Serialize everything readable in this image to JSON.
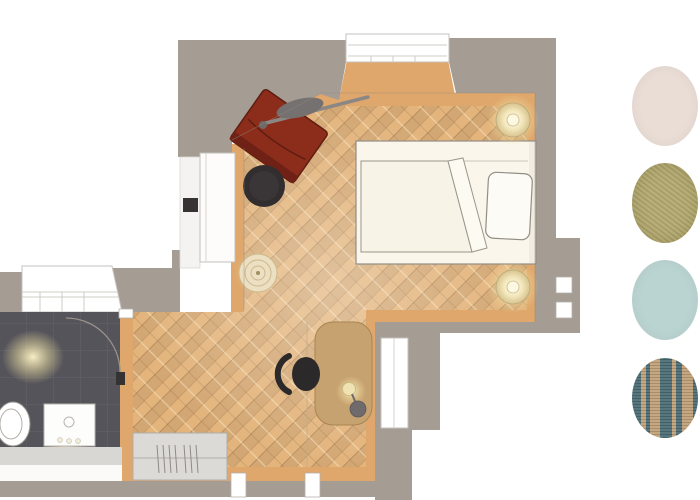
{
  "scene": {
    "kind": "apartment-floor-plan-render",
    "colors": {
      "wall": "#a59c94",
      "wall_face": "#dfa76c",
      "floor": "#e3b47c",
      "tile": "#55545a",
      "tile_grid": "#65646b",
      "window_frame": "#c6c2bd",
      "fixture": "#ffffff",
      "radiator": "#dcdad7",
      "radiator_line": "#b0ada8",
      "bed": "#faf6ec",
      "bed_outline": "#918e86",
      "duvet": "#f8f3e7",
      "pillow": "#fdfbf5",
      "chair_red": "#8c2d1c",
      "chair_red_dark": "#5f1d10",
      "pouf": "#322e2f",
      "basket": "#ecdfc2",
      "basket_ring": "#cbb98e",
      "desk": "#c7a271",
      "desk_edge": "#a8854f",
      "office_chair": "#2c292a",
      "lamp_shade": "#6f6b6d",
      "wardrobe": "#fdfcfa",
      "handle": "#363233"
    },
    "rooms": [
      "bedroom",
      "hallway",
      "bathroom"
    ],
    "furniture": [
      "bed",
      "pillow",
      "duvet",
      "bedside-lamp",
      "bedside-lamp",
      "red-armchair",
      "floor-lamp",
      "pouf",
      "round-basket",
      "wardrobe",
      "desk",
      "desk-lamp",
      "office-chair",
      "toilet",
      "vanity-sink",
      "radiator",
      "ceiling-light"
    ]
  },
  "palette": {
    "swatches": [
      {
        "name": "blush-plaster",
        "style": "solid",
        "color": "#eaddd6"
      },
      {
        "name": "olive-gold-linen",
        "style": "textured",
        "color": "#b2a86e"
      },
      {
        "name": "powder-blue",
        "style": "solid",
        "color": "#bad4d2"
      },
      {
        "name": "teal-tan-stripe-fabric",
        "style": "striped",
        "stripes": [
          {
            "color": "#4e6f77",
            "w": 9
          },
          {
            "color": "#c2a37a",
            "w": 5
          },
          {
            "color": "#4e6f77",
            "w": 4
          },
          {
            "color": "#c2a37a",
            "w": 10
          },
          {
            "color": "#4e6f77",
            "w": 12
          },
          {
            "color": "#c2a37a",
            "w": 4
          },
          {
            "color": "#4e6f77",
            "w": 6
          },
          {
            "color": "#c2a37a",
            "w": 11
          }
        ]
      }
    ]
  }
}
